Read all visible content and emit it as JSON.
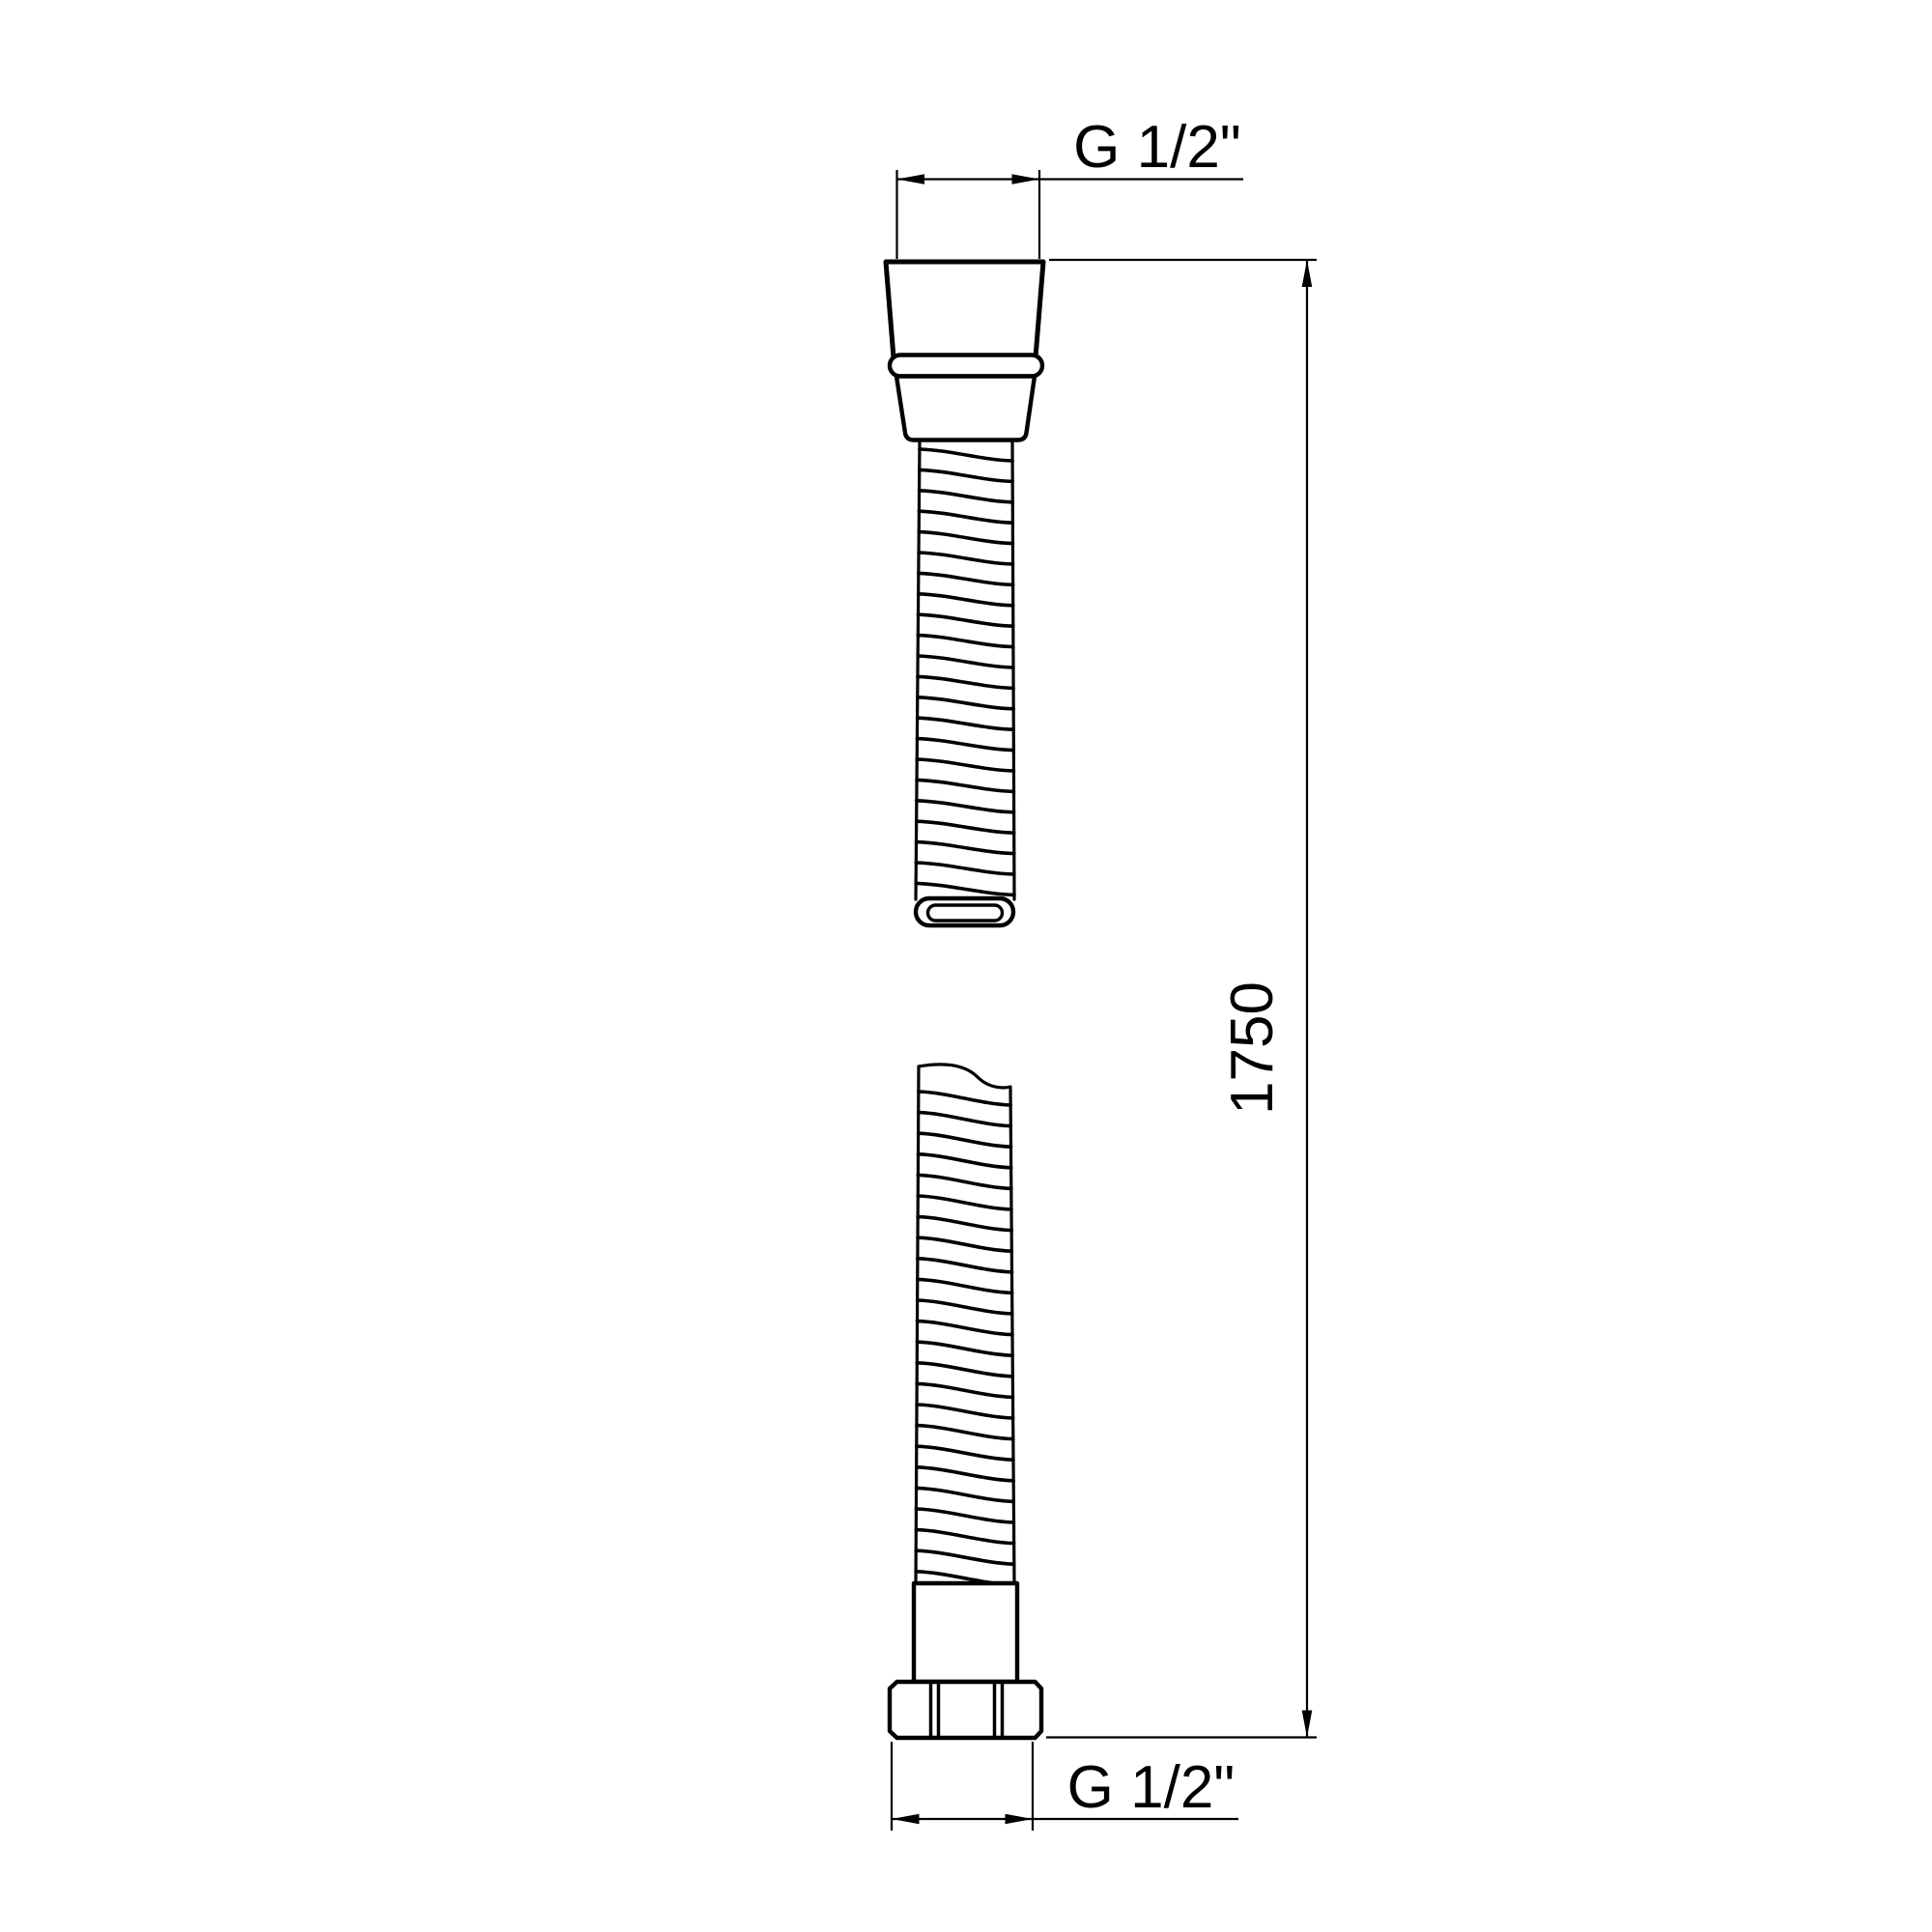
{
  "drawing": {
    "type": "technical-dimension-drawing",
    "subject": "flexible shower hose with conical connector, o-ring, spiral hose (break view) and hex nut",
    "labels": {
      "top_thread": "G 1/2\"",
      "bottom_thread": "G 1/2\"",
      "length": "1750"
    },
    "colors": {
      "line": "#000000",
      "oring_fill": "#c4c4c4",
      "background": "#ffffff"
    }
  }
}
